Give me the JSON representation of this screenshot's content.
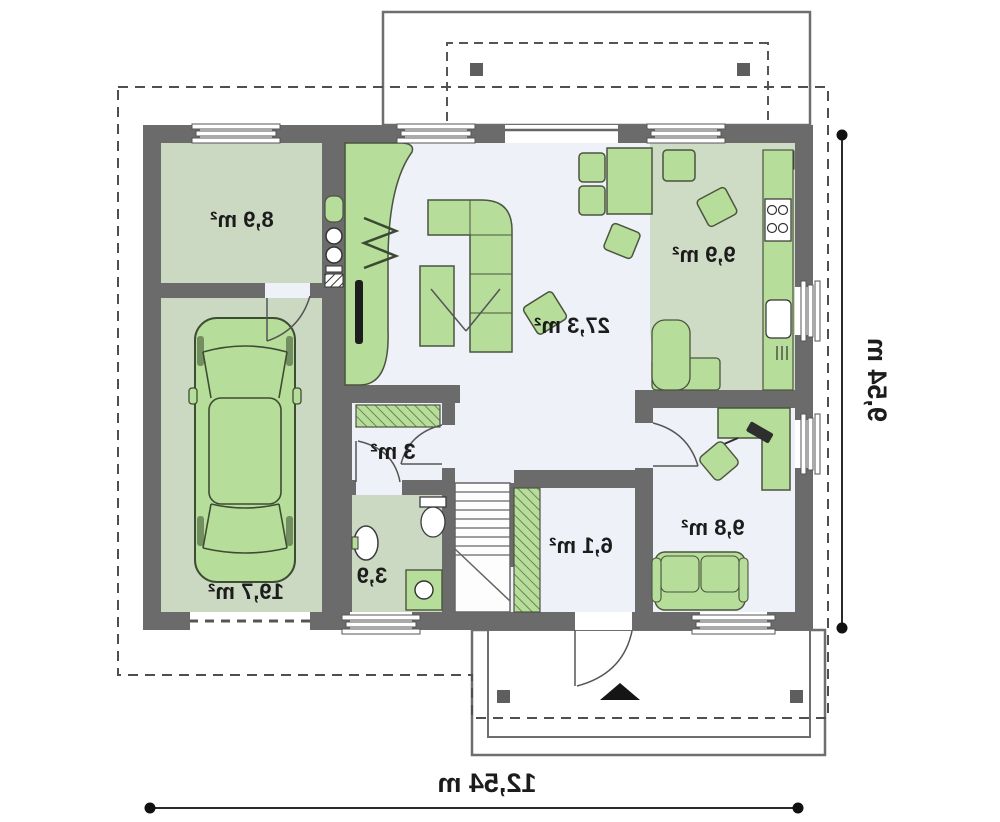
{
  "plan": {
    "rooms": [
      {
        "key": "living",
        "area": "27,3 m²"
      },
      {
        "key": "kitchen",
        "area": "9,9 m²"
      },
      {
        "key": "storage",
        "area": "8,9 m²"
      },
      {
        "key": "garage",
        "area": "19,7 m²"
      },
      {
        "key": "wardrobe",
        "area": "3 m²"
      },
      {
        "key": "bathroom",
        "area": "3,9"
      },
      {
        "key": "hall",
        "area": "6,1 m²"
      },
      {
        "key": "office",
        "area": "9,8 m²"
      }
    ],
    "dimensions": {
      "total_width": "12,54 m",
      "total_depth": "9,54 m"
    },
    "colors": {
      "wall": "#6b6b6b",
      "floor_green": "#ccd9c2",
      "floor_light": "#eef1f7",
      "kitchen_floor": "#cfdcc5",
      "furniture": "#b7dd9a",
      "outline": "#4a553f"
    }
  }
}
